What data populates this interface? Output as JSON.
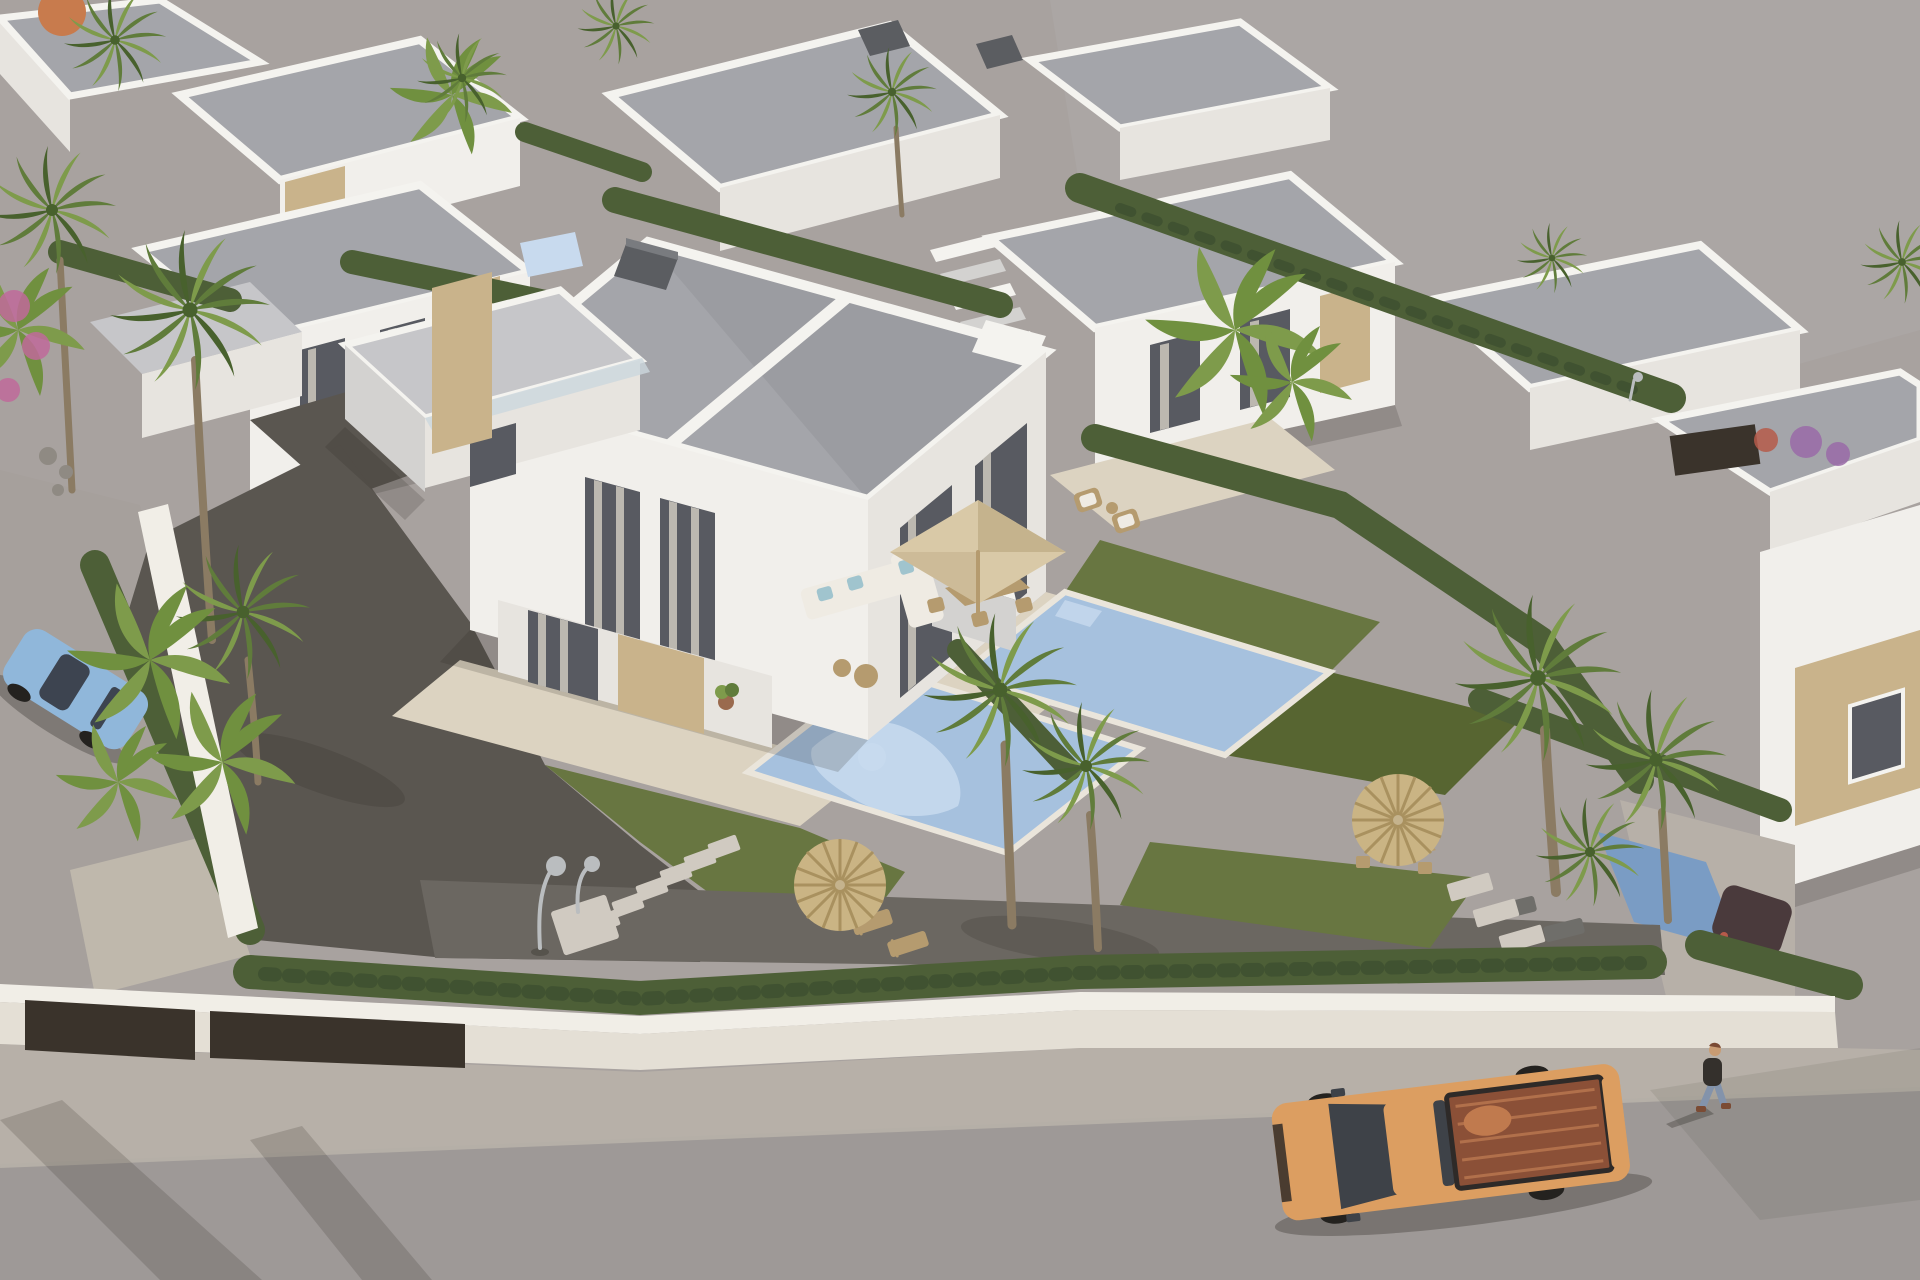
{
  "scene": {
    "description": "Aerial 3D architectural rendering of a development of modern white flat-roofed villas with private pools, lawns, hedges and palm trees; an orange pickup truck drives on the street in front and a pedestrian walks on the sidewalk",
    "objects": [
      {
        "name": "main-duplex-villa",
        "label": "Two-storey white duplex villa with gravel flat roof, stone cladding and glass balcony"
      },
      {
        "name": "central-pool",
        "label": "Private mosaic-tiled swimming pool with figure pattern"
      },
      {
        "name": "right-pool",
        "label": "Neighbouring villa swimming pool"
      },
      {
        "name": "background-villas",
        "label": "Rows of identical white villas with hedges between plots"
      },
      {
        "name": "empty-lot",
        "label": "Vacant grey plot at the top right"
      },
      {
        "name": "orange-pickup-truck",
        "label": "Orange pickup truck with open cargo bed driving on the street"
      },
      {
        "name": "blue-car",
        "label": "Light blue car parked on the left street behind plants"
      },
      {
        "name": "dark-car",
        "label": "Dark car parked in the right driveway behind a hedge"
      },
      {
        "name": "pedestrian",
        "label": "Person in dark shirt and jeans walking on the sidewalk"
      },
      {
        "name": "straw-umbrellas",
        "label": "Round straw parasols with sun loungers on the lawns"
      },
      {
        "name": "beige-parasol",
        "label": "Square beige patio parasol over outdoor dining set"
      },
      {
        "name": "orange-parasol",
        "label": "Orange parasol in a background garden"
      },
      {
        "name": "outdoor-sofa",
        "label": "White corner sofa with light blue cushions"
      },
      {
        "name": "outdoor-shower",
        "label": "Garden shower and concrete stepping stones"
      },
      {
        "name": "perimeter-wall",
        "label": "White perimeter wall with dark entrance gates and trimmed hedge"
      }
    ]
  },
  "palette": {
    "ground": "#a8a29f",
    "lot": "#aba6a4",
    "street_left": "#a6a09c",
    "road": "#9e9997",
    "sidewalk": "#b7b0a8",
    "wall_top": "#f1eee7",
    "wall_face": "#e4dfd5",
    "gate_dark": "#3a332b",
    "roof_gravel": "#a4a5aa",
    "roof_light": "#c6c6c9",
    "parapet": "#f4f3ef",
    "facade_bright": "#f1efeb",
    "facade_medium": "#e7e4df",
    "facade_shadow": "#d3d2d0",
    "stone": "#c9b38b",
    "stone_dark": "#ae9770",
    "window_dark": "#585a61",
    "curtain": "#bcb8b0",
    "glass_rail": "#ccd7dd",
    "terrace": "#dcd3c1",
    "terrace_shadow": "#cdc3af",
    "pool": "#a6c1de",
    "pool_light": "#c8daee",
    "pool_deep": "#7a9cc4",
    "coping": "#eae5db",
    "lawn": "#687641",
    "lawn_dark": "#576531",
    "hedge": "#4d5f37",
    "hedge_dark": "#405231",
    "gravel": "#5a5650",
    "gravel_light": "#6b6761",
    "path": "#bfb8ac",
    "palm": "#607c3b",
    "palm_light": "#7e9b4b",
    "palm_dark": "#48612d",
    "trunk": "#8b7b63",
    "banana": "#70903f",
    "flower_pink": "#c06a9a",
    "flower_purple": "#9a6aa8",
    "flower_red": "#b65a4a",
    "umbrella_beige": "#d9c9a7",
    "umbrella_beige_dark": "#c5b38d",
    "umbrella_straw": "#cab484",
    "umbrella_straw_dark": "#a9915f",
    "umbrella_orange": "#c87b4d",
    "wood": "#b59b6f",
    "sofa_white": "#efebe3",
    "pillow_blue": "#a0c4ce",
    "truck_body": "#dc9e61",
    "truck_bed": "#8b5037",
    "truck_bed_light": "#b1704b",
    "truck_glass": "#3e4248",
    "tire": "#24221f",
    "car_blue": "#90b7da",
    "car_glass": "#3d4450",
    "dark_car": "#4a3a3c",
    "person_shirt": "#34302c",
    "person_jeans": "#8393ab",
    "person_skin": "#c99c73",
    "person_shoe": "#7b4b34",
    "shadow": "rgba(45,40,35,0.18)",
    "shadow_strong": "rgba(45,40,35,0.32)",
    "lamp_metal": "#babdbf",
    "chimney": "#5b5d61",
    "chimney_light": "#797b7f",
    "stone_step": "#d0cac1",
    "lounger_dark": "#6f6e6a"
  }
}
